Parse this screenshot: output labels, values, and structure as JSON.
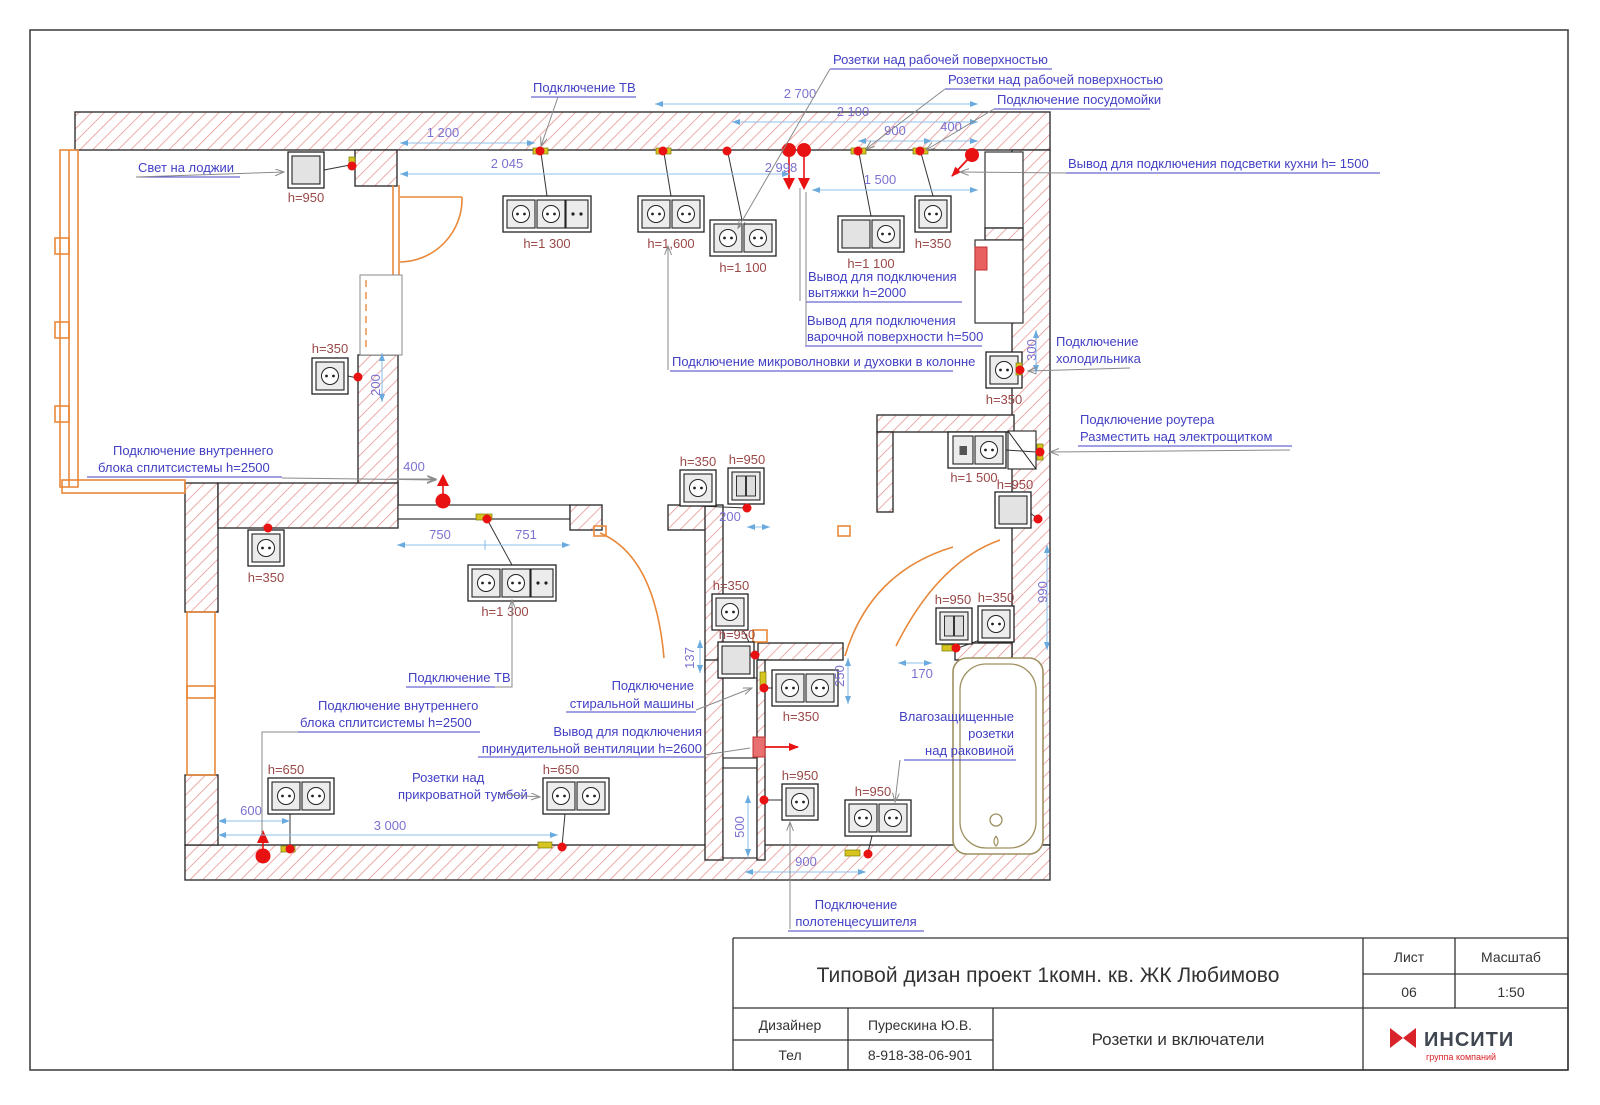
{
  "callouts": [
    {
      "lines": [
        "Розетки над рабочей поверхностью"
      ]
    },
    {
      "lines": [
        "Розетки над рабочей поверхностью"
      ]
    },
    {
      "lines": [
        "Подключение посудомойки"
      ]
    },
    {
      "lines": [
        "Подключение ТВ"
      ]
    },
    {
      "lines": [
        "Свет на лоджии"
      ]
    },
    {
      "lines": [
        "Вывод для подключения подсветки кухни  h= 1500"
      ]
    },
    {
      "lines": [
        "Вывод для подключения",
        "вытяжки h=2000"
      ]
    },
    {
      "lines": [
        "Вывод для подключения",
        "варочной поверхности h=500"
      ]
    },
    {
      "lines": [
        "Подключение микроволновки и духовки в колонне"
      ]
    },
    {
      "lines": [
        "Подключение",
        "холодильника"
      ]
    },
    {
      "lines": [
        "Подключение роутера",
        "Разместить над электрощитком"
      ]
    },
    {
      "lines": [
        "Подключение внутреннего",
        "блока сплитсистемы h=2500"
      ]
    },
    {
      "lines": [
        "Подключение ТВ"
      ]
    },
    {
      "lines": [
        "Подключение внутреннего",
        "блока сплитсистемы h=2500"
      ]
    },
    {
      "lines": [
        "Розетки над",
        "прикроватной тумбой"
      ]
    },
    {
      "lines": [
        "Подключение",
        "стиральной машины"
      ]
    },
    {
      "lines": [
        "Вывод для подключения",
        "принудительной вентиляции h=2600"
      ]
    },
    {
      "lines": [
        "Влагозащищенные",
        "розетки",
        "над раковиной"
      ]
    },
    {
      "lines": [
        "Подключение",
        "полотенцесушителя"
      ]
    }
  ],
  "dims": [
    "2 700",
    "2 100",
    "900",
    "400",
    "2 998",
    "1 500",
    "1 200",
    "2 045",
    "200",
    "400",
    "750",
    "751",
    "200",
    "300",
    "990",
    "170",
    "137",
    "250",
    "500",
    "900",
    "600",
    "3 000"
  ],
  "heights": [
    "h=950",
    "h=1 300",
    "h=1,600",
    "h=1 100",
    "h=1 100",
    "h=350",
    "h=350",
    "h=1 500",
    "h=950",
    "h=350",
    "h=350",
    "h=1 300",
    "h=350",
    "h=950",
    "h=350",
    "h=950",
    "h=350",
    "h=950",
    "h=950",
    "h=950",
    "h=350",
    "h=650",
    "h=650"
  ],
  "title_block": {
    "project": "Типовой дизан проект 1комн. кв. ЖК Любимово",
    "sheet_label": "Лист",
    "sheet_value": "06",
    "scale_label": "Масштаб",
    "scale_value": "1:50",
    "designer_label": "Дизайнер",
    "designer_value": "Пурескина Ю.В.",
    "phone_label": "Тел",
    "phone_value": "8-918-38-06-901",
    "drawing_name": "Розетки и включатели",
    "logo_text": "ИНСИТИ",
    "logo_sub": "группа компаний"
  },
  "colors": {
    "callout": "#4340c4",
    "dim_text": "#7a72d0",
    "dim_line": "#8fc1ea",
    "height_text": "#9a4848",
    "wall_hatch": "#e89090",
    "orange": "#e8883a",
    "red": "#e81212",
    "yellow": "#d6c520",
    "tub": "#a09060",
    "logo_red": "#d8232a"
  }
}
